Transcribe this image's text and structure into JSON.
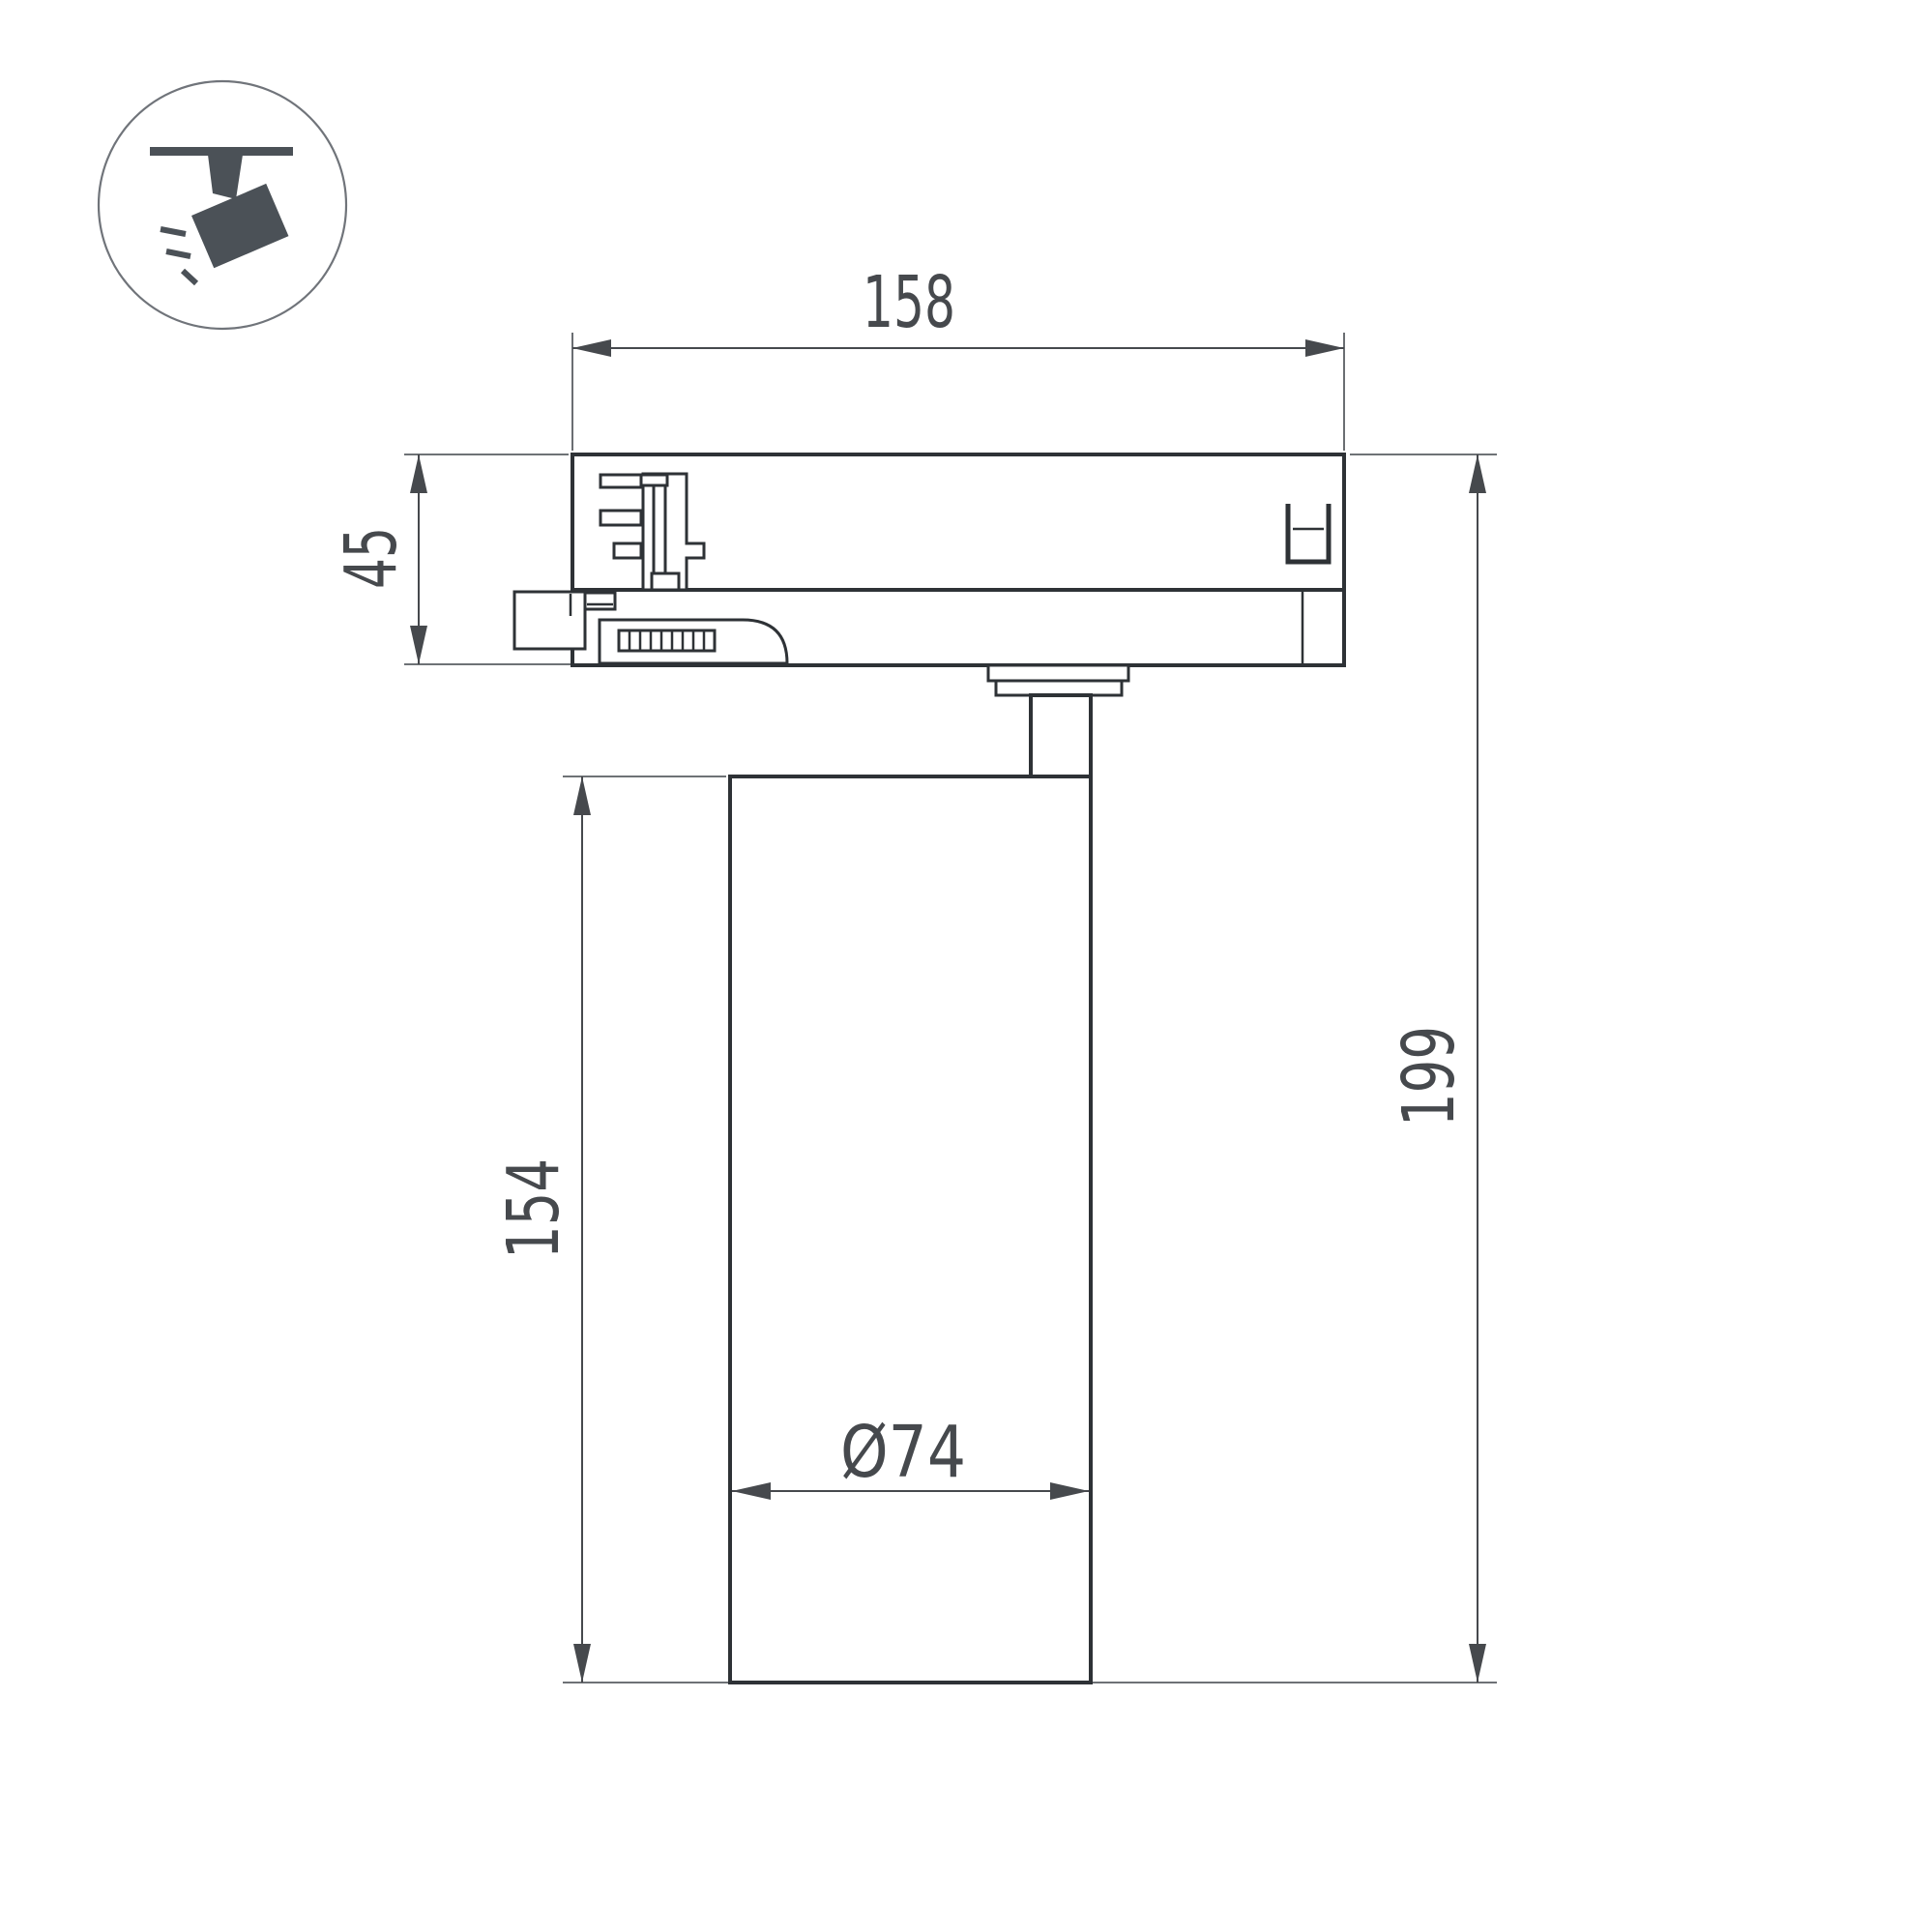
{
  "drawing": {
    "type": "technical-dimension-drawing",
    "subject": "led-track-spotlight-side-view"
  },
  "icon": {
    "name": "track-spotlight-pictogram",
    "color": "#4b5157"
  },
  "colors": {
    "background": "#ffffff",
    "outline": "#2e3236",
    "dimension": "#46494d",
    "extension": "#5a5e62",
    "icon": "#4b5157",
    "circle": "#70747a"
  },
  "dimensions": {
    "adapter_width": "158",
    "adapter_height": "45",
    "body_height": "154",
    "total_height": "199",
    "body_diameter": "Ø74"
  }
}
